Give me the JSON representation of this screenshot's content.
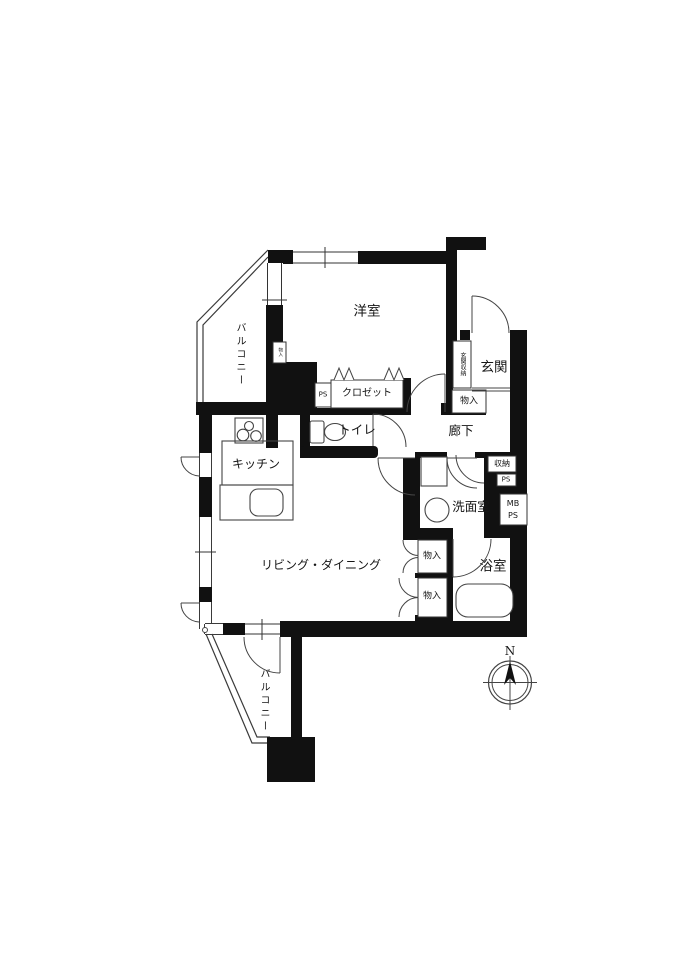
{
  "floorplan": {
    "background_color": "#ffffff",
    "wall_color": "#111111",
    "line_color": "#333333",
    "rooms": {
      "western_room": "洋室",
      "balcony_top": "バルコニー",
      "balcony_bottom": "バルコニー",
      "entrance": "玄関",
      "hallway": "廊下",
      "kitchen": "キッチン",
      "living_dining": "リビング・ダイニング",
      "washroom": "洗面室",
      "bathroom": "浴室",
      "toilet": "トイレ"
    },
    "storage": {
      "entrance_tall_cabinet": "玄関収納",
      "entrance_cabinet": "物入",
      "closet": "クロゼット",
      "closet_ps": "PS",
      "hall_storage": "収納",
      "hall_ps": "PS",
      "meter_box_line1": "MB",
      "meter_box_line2": "PS",
      "washroom_side_upper": "物入",
      "washroom_side_lower": "物入",
      "wall_tag": "物入"
    },
    "compass": {
      "north": "N"
    }
  }
}
